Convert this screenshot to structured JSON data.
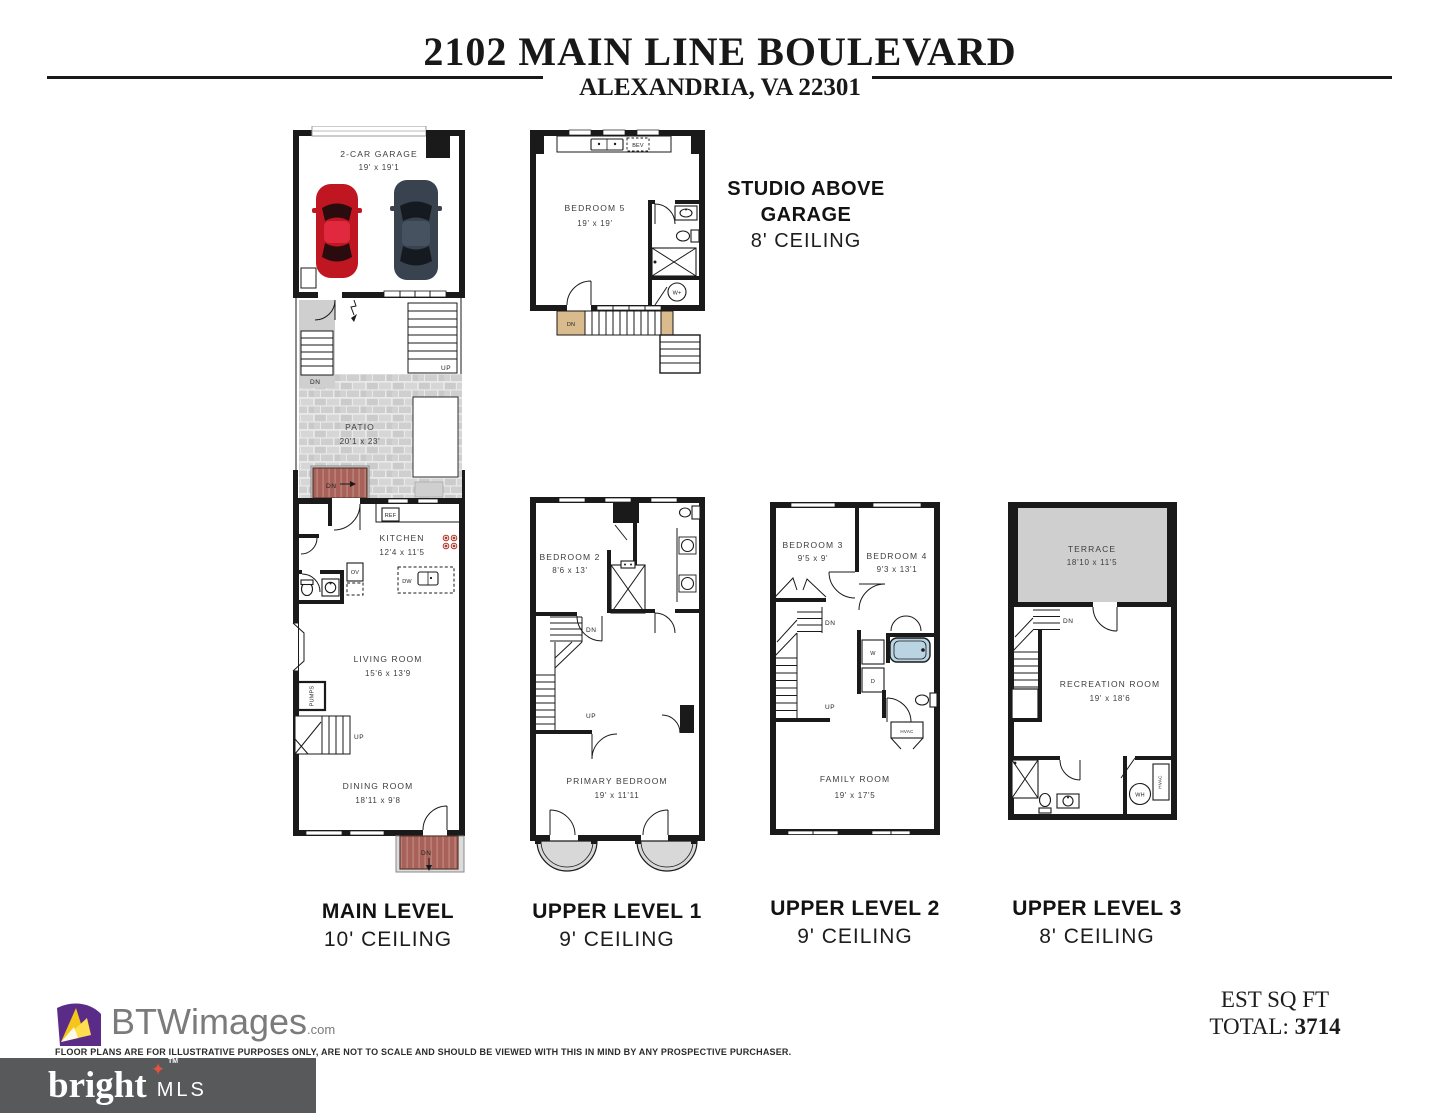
{
  "header": {
    "title": "2102 MAIN LINE BOULEVARD",
    "subtitle": "ALEXANDRIA, VA 22301"
  },
  "studio_callout": {
    "line1": "STUDIO ABOVE",
    "line2": "GARAGE",
    "ceiling": "8' CEILING"
  },
  "plans": {
    "main": {
      "level_name": "MAIN LEVEL",
      "ceiling": "10' CEILING",
      "garage": {
        "name": "2-CAR GARAGE",
        "dims": "19' x 19'1"
      },
      "patio": {
        "name": "PATIO",
        "dims": "20'1 x 23'"
      },
      "kitchen": {
        "name": "KITCHEN",
        "dims": "12'4 x 11'5"
      },
      "living": {
        "name": "LIVING ROOM",
        "dims": "15'6 x 13'9"
      },
      "dining": {
        "name": "DINING ROOM",
        "dims": "18'11 x 9'8"
      },
      "labels": {
        "ref": "REF",
        "ov": "OV",
        "dw": "DW",
        "pumps": "PUMPS",
        "up": "UP",
        "dn": "DN"
      }
    },
    "studio": {
      "bedroom5": {
        "name": "BEDROOM 5",
        "dims": "19' x 19'"
      },
      "labels": {
        "bev": "BEV",
        "dn": "DN",
        "wplus": "W+"
      }
    },
    "upper1": {
      "level_name": "UPPER LEVEL 1",
      "ceiling": "9' CEILING",
      "bedroom2": {
        "name": "BEDROOM 2",
        "dims": "8'6 x 13'"
      },
      "primary": {
        "name": "PRIMARY BEDROOM",
        "dims": "19' x 11'11"
      },
      "labels": {
        "dn": "DN",
        "up": "UP"
      }
    },
    "upper2": {
      "level_name": "UPPER LEVEL 2",
      "ceiling": "9' CEILING",
      "bedroom3": {
        "name": "BEDROOM 3",
        "dims": "9'5 x 9'"
      },
      "bedroom4": {
        "name": "BEDROOM 4",
        "dims": "9'3 x 13'1"
      },
      "family": {
        "name": "FAMILY ROOM",
        "dims": "19' x 17'5"
      },
      "labels": {
        "dn": "DN",
        "up": "UP",
        "w": "W",
        "d": "D",
        "hvac": "HVAC"
      }
    },
    "upper3": {
      "level_name": "UPPER LEVEL 3",
      "ceiling": "8' CEILING",
      "terrace": {
        "name": "TERRACE",
        "dims": "18'10 x 11'5"
      },
      "recreation": {
        "name": "RECREATION ROOM",
        "dims": "19' x 18'6"
      },
      "labels": {
        "dn": "DN",
        "wh": "WH",
        "hvac": "HVAC"
      }
    }
  },
  "footer": {
    "logo_text": "BTWimages",
    "logo_suffix": ".com",
    "disclaimer": "FLOOR PLANS ARE FOR ILLUSTRATIVE PURPOSES ONLY, ARE NOT TO SCALE AND SHOULD BE VIEWED WITH THIS IN MIND BY ANY PROSPECTIVE PURCHASER.",
    "est_label": "EST SQ FT",
    "total_label": "TOTAL:",
    "total_value": "3714",
    "mls_brand": "bright",
    "mls_tm": "TM",
    "mls_suffix": "MLS"
  },
  "colors": {
    "wall": "#1a1a1a",
    "patio_gray": "#cfcfcf",
    "deck_red": "#a8625a",
    "stair_wood": "#d9bb8e",
    "tub_blue": "#bad4e4",
    "car_red": "#c01622",
    "car_dark": "#39434f",
    "mls_bg": "#58595b",
    "mls_star": "#e2523e",
    "logo_purple": "#5b2c87",
    "logo_yellow": "#f6c51c"
  }
}
